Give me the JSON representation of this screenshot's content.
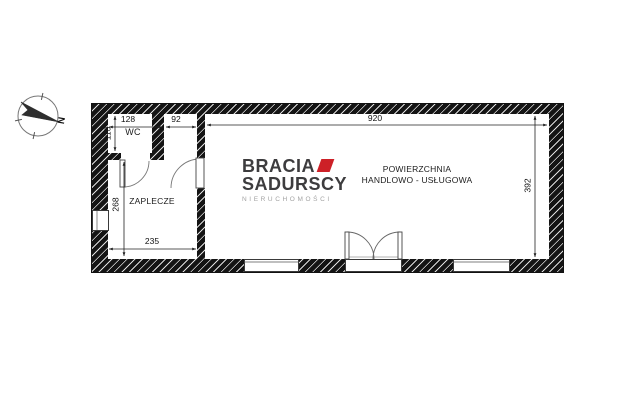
{
  "compass": {
    "label": "N"
  },
  "logo": {
    "line1": "BRACIA",
    "line2": "SADURSCY",
    "subtitle": "NIERUCHOMOŚCI",
    "accent_color": "#cd2027",
    "text_color": "#3d3c3e"
  },
  "rooms": {
    "wc": {
      "label": "WC"
    },
    "zaplecze": {
      "label": "ZAPLECZE"
    },
    "main": {
      "label_line1": "POWIERZCHNIA",
      "label_line2": "HANDLOWO - USŁUGOWA"
    }
  },
  "dimensions": {
    "wc_width": "128",
    "gap_width": "92",
    "wc_height": "110",
    "zaplecze_height": "268",
    "zaplecze_width": "235",
    "main_width": "920",
    "main_height": "392"
  }
}
